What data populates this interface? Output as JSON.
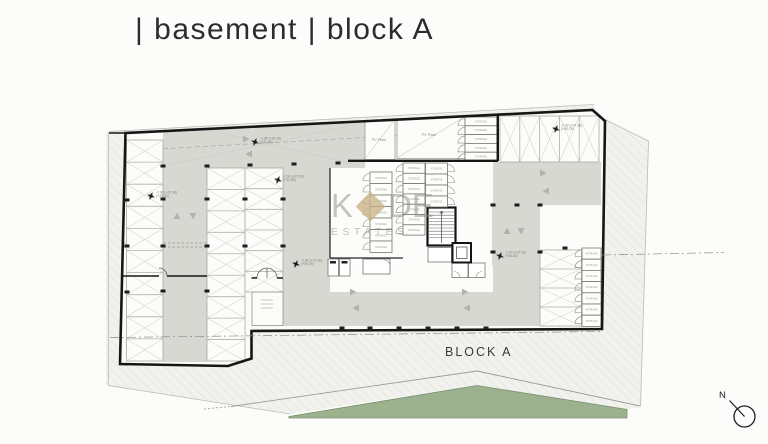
{
  "header": {
    "title": "| basement | block A"
  },
  "watermark": {
    "k": "K",
    "de": "DE",
    "estates": "ESTATES"
  },
  "plan": {
    "block_label": "BLOCK A",
    "compass_label": "N",
    "room_labels": {
      "pv_plant": "PV Plant",
      "storage": "STORAGE"
    },
    "level_annotations": [
      {
        "x": 255,
        "y": 142,
        "line1": "-2.90 (+37.30)",
        "line2": "(+41.00)"
      },
      {
        "x": 278,
        "y": 180,
        "line1": "-2.90 (+37.30)",
        "line2": "(+41.00)"
      },
      {
        "x": 151,
        "y": 196,
        "line1": "-2.90 (+37.30)",
        "line2": "(+43.00)"
      },
      {
        "x": 296,
        "y": 264,
        "line1": "-2.90 (+37.30)",
        "line2": "(+39.75)"
      },
      {
        "x": 556,
        "y": 129,
        "line1": "-2.90 (+37.30)",
        "line2": "(+43.75)"
      },
      {
        "x": 500,
        "y": 256,
        "line1": "-2.90 (+37.30)",
        "line2": "(+40.50)"
      }
    ],
    "colors": {
      "drive_aisle": "#d7d8d2",
      "landscape_green": "#9cb28e",
      "watermark_gold": "#ccb78c"
    }
  }
}
